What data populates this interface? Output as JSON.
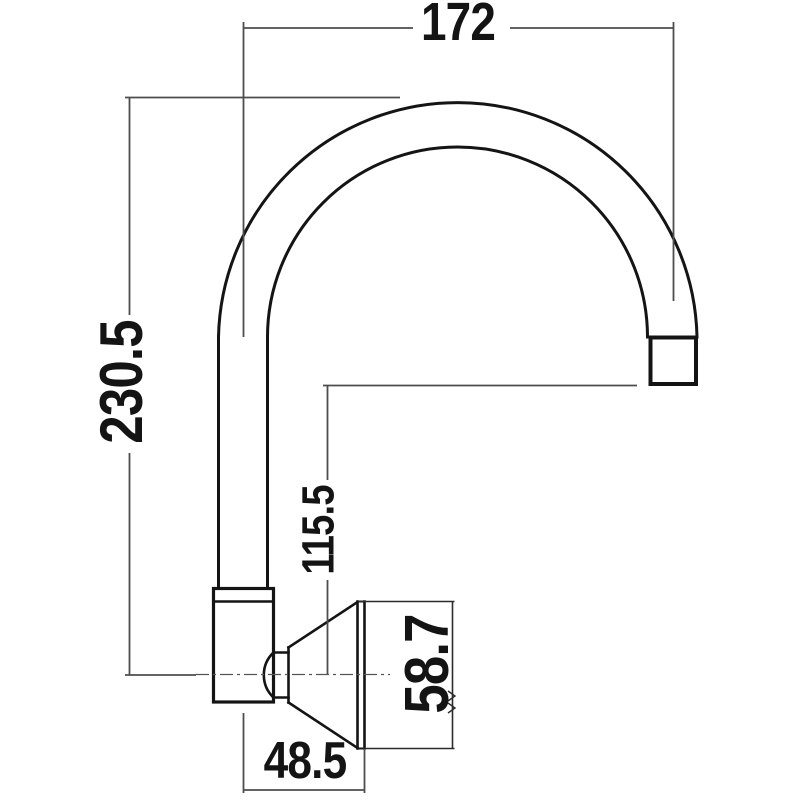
{
  "drawing": {
    "type": "technical-dimension-drawing",
    "subject": "wall-mounted gooseneck faucet spout, side elevation",
    "units": "mm",
    "background_color": "#ffffff",
    "outline_color": "#141414",
    "dimension_line_color": "#4d4d4d",
    "centerline_color": "#555555",
    "text_color": "#141414",
    "dimensions": {
      "spout_reach": {
        "value": "172",
        "orientation": "horizontal",
        "location": "top"
      },
      "overall_height": {
        "value": "230.5",
        "orientation": "vertical",
        "location": "left"
      },
      "outlet_height": {
        "value": "115.5",
        "orientation": "vertical",
        "location": "middle"
      },
      "flange_diameter": {
        "value": "58.7",
        "orientation": "vertical",
        "location": "right-of-flange"
      },
      "wall_projection": {
        "value": "48.5",
        "orientation": "horizontal",
        "location": "bottom"
      }
    }
  }
}
